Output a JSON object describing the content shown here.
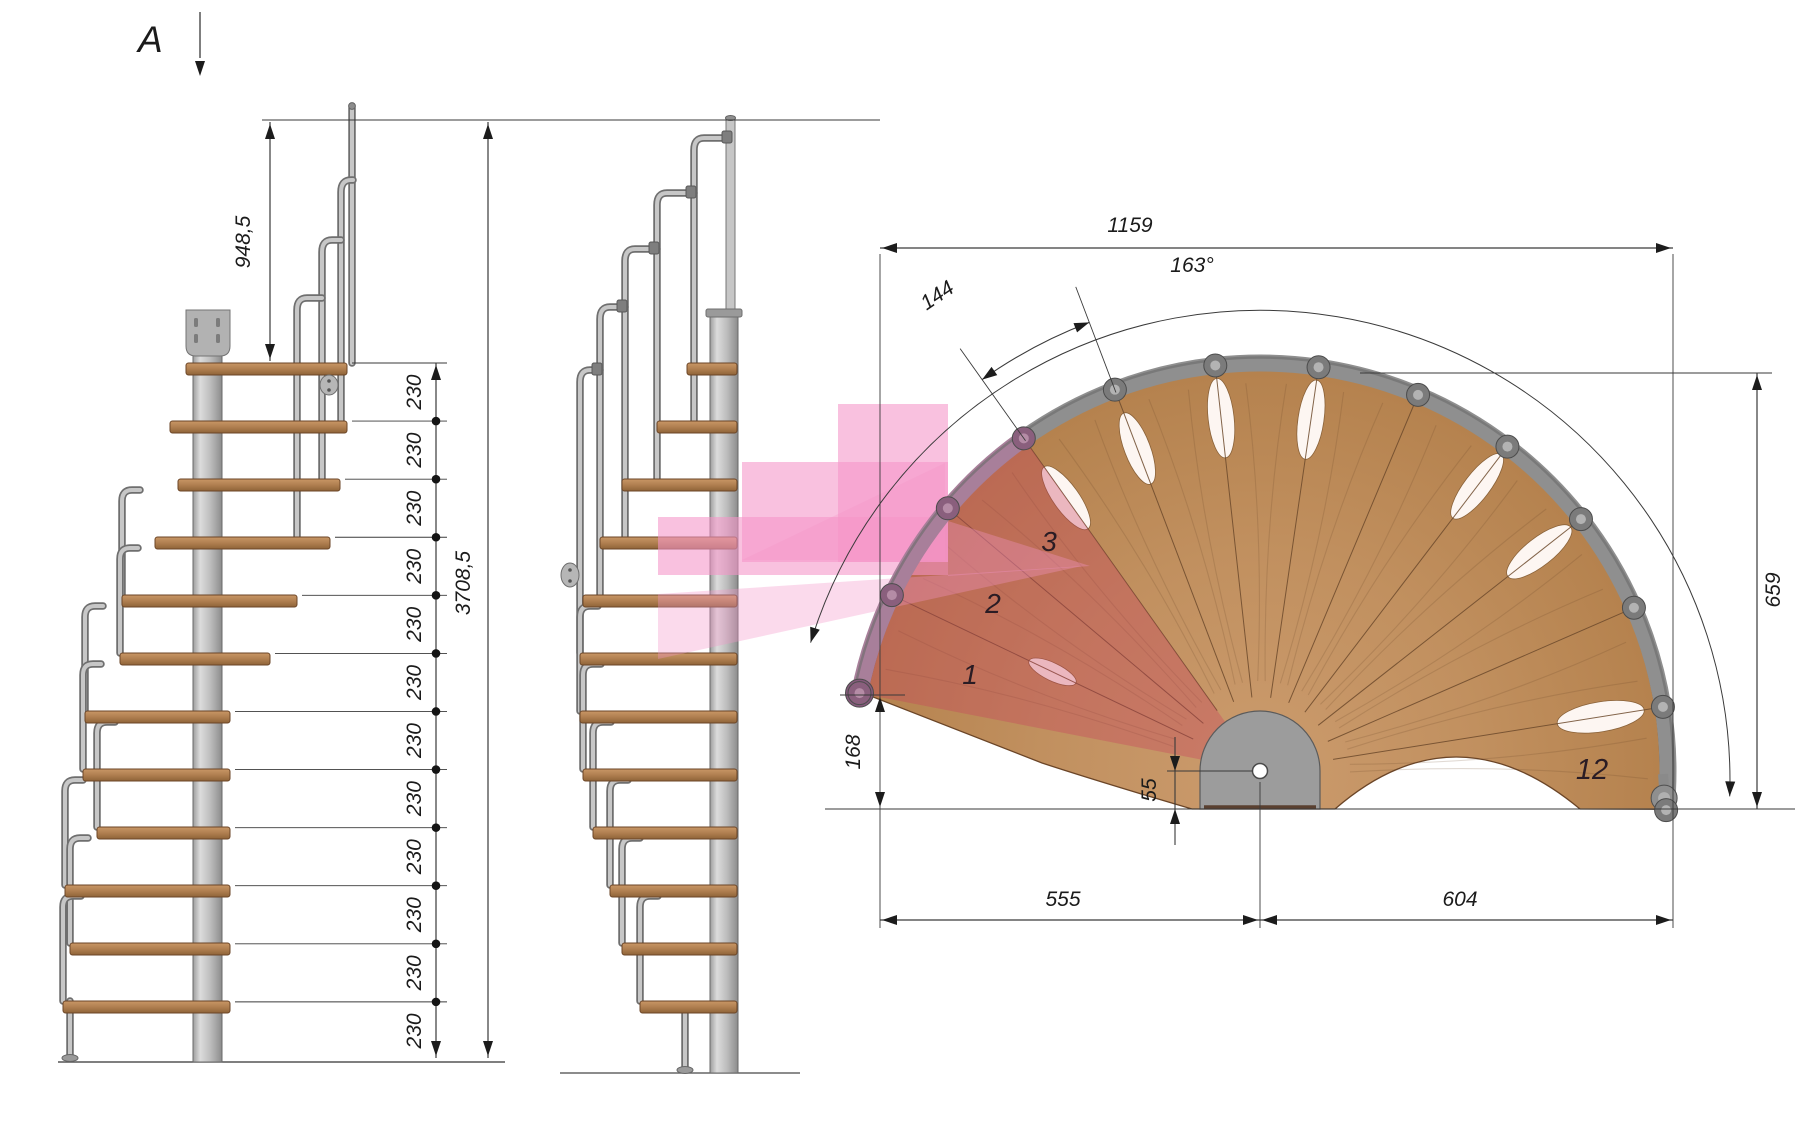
{
  "section_marker": {
    "label": "A"
  },
  "side_view": {
    "dim_handrail_height": "948,5",
    "dim_total_height": "3708,5",
    "riser_value": "230",
    "riser_count": 12,
    "riser_labels": [
      "230",
      "230",
      "230",
      "230",
      "230",
      "230",
      "230",
      "230",
      "230",
      "230",
      "230",
      "230"
    ]
  },
  "plan_view": {
    "step_count": 12,
    "dim_total_width": "1159",
    "dim_total_angle": "163°",
    "dim_step_arc_length": "144",
    "dim_outer_height": "659",
    "dim_first_step_rise": "168",
    "dim_center_offset": "55",
    "dim_left_of_center": "555",
    "dim_right_of_center": "604",
    "step_label_1": "1",
    "step_label_2": "2",
    "step_label_3": "3",
    "step_label_12": "12"
  },
  "colors": {
    "wood": "#c1905f",
    "wood_edge": "#6b4527",
    "metal_light": "#c7c7c7",
    "metal_mid": "#a8a8a8",
    "metal_dark": "#6e6e6e",
    "highlight_pink": "#f495c8",
    "highlight_red_tint": "rgba(199,62,95,0.34)",
    "dim_line": "#3a3a3a",
    "text": "#1b1b1b"
  }
}
